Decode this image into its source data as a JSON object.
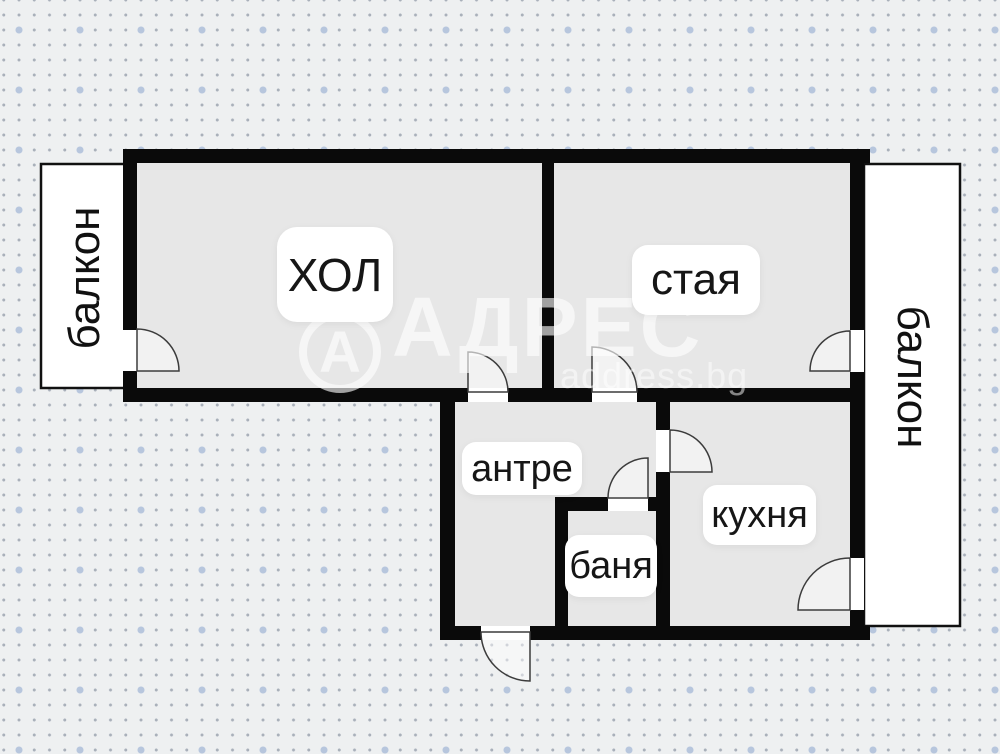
{
  "labels": {
    "hol": "ХОЛ",
    "staya": "стая",
    "antre": "антре",
    "banya": "баня",
    "kuhnya": "кухня",
    "balkon_left": "балкон",
    "balkon_right": "балкон"
  },
  "watermark": {
    "logo_letter": "А",
    "brand": "АДРЕС",
    "site": "address.bg"
  },
  "colors": {
    "wall": "#0a0a0a",
    "floor": "#e7e7e7",
    "balcony_fill": "#ffffff",
    "balcony_border": "#111111",
    "door_stroke": "#3c3c3c",
    "page_background": "#eef0f1",
    "dot_small": "#a9b0ba",
    "dot_large": "#b7c6dd",
    "watermark_white": "rgba(255,255,255,0.62)"
  }
}
